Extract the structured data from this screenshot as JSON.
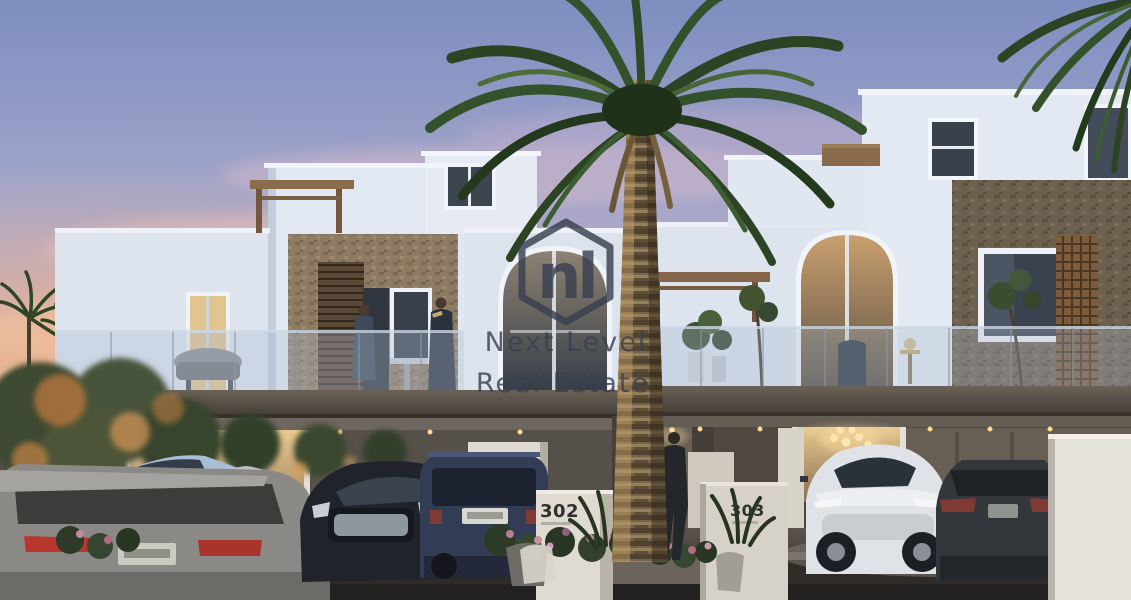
{
  "watermark": {
    "logo_monogram": "nl",
    "logo_shape": "hexagon-outline-icon",
    "brand_line1": "Next Level",
    "brand_line2": "Real Estate",
    "color": "#394050"
  },
  "property": {
    "unit_number_left": "302",
    "unit_number_right": "303"
  },
  "palette": {
    "sky_top": "#7e8ec0",
    "sky_pink": "#e2b2b4",
    "sunset_glow": "#f6bd7c",
    "facade_white": "#e3e9f2",
    "stone_accent": "#8d7b64",
    "stone_dark": "#6e604f",
    "slab_brown": "#575047",
    "road_dark": "#2e2b28",
    "warm_light": "#f3d7a0",
    "palm_green": "#2c4424"
  }
}
